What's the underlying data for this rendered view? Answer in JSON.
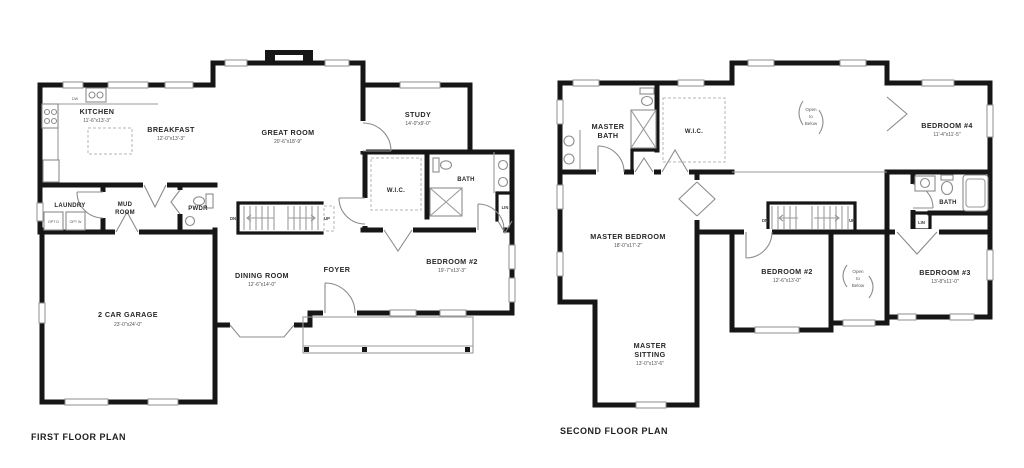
{
  "colors": {
    "wall": "#161616",
    "line": "#8c8c8c",
    "text": "#272727"
  },
  "first_floor": {
    "title": "FIRST FLOOR PLAN",
    "rooms": {
      "kitchen": {
        "name": "KITCHEN",
        "dims": "11'-6\"x13'-3\""
      },
      "breakfast": {
        "name": "BREAKFAST",
        "dims": "12'-0\"x13'-3\""
      },
      "great_room": {
        "name": "GREAT ROOM",
        "dims": "20'-6\"x18'-9\""
      },
      "study": {
        "name": "STUDY",
        "dims": "14'-0\"x9'-0\""
      },
      "laundry": {
        "name": "LAUNDRY"
      },
      "mud_room": {
        "line1": "MUD",
        "line2": "ROOM"
      },
      "pwdr": {
        "name": "PWDR"
      },
      "wic": {
        "name": "W.I.C."
      },
      "bath": {
        "name": "BATH"
      },
      "lin": {
        "name": "LIN"
      },
      "dining": {
        "name": "DINING ROOM",
        "dims": "12'-6\"x14'-0\""
      },
      "foyer": {
        "name": "FOYER"
      },
      "bedroom2": {
        "name": "BEDROOM #2",
        "dims": "19'-7\"x13'-3\""
      },
      "garage": {
        "name": "2 CAR GARAGE",
        "dims": "23'-0\"x24'-0\""
      }
    },
    "stairs": {
      "dn": "DN",
      "up": "UP"
    },
    "appliances": {
      "dw": "DW",
      "opt_d": "OPT D",
      "opt_w": "OPT W"
    }
  },
  "second_floor": {
    "title": "SECOND FLOOR PLAN",
    "rooms": {
      "master_bath": {
        "line1": "MASTER",
        "line2": "BATH"
      },
      "wic": {
        "name": "W.I.C."
      },
      "bedroom4": {
        "name": "BEDROOM #4",
        "dims": "11'-4\"x11'-5\""
      },
      "master_bedroom": {
        "name": "MASTER BEDROOM",
        "dims": "18'-0\"x17'-2\""
      },
      "bath": {
        "name": "BATH"
      },
      "lin": {
        "name": "LIN"
      },
      "bedroom2": {
        "name": "BEDROOM #2",
        "dims": "12'-6\"x13'-0\""
      },
      "bedroom3": {
        "name": "BEDROOM #3",
        "dims": "13'-8\"x11'-0\""
      },
      "master_sitting": {
        "line1": "MASTER",
        "line2": "SITTING",
        "dims": "13'-0\"x13'-6\""
      }
    },
    "open_below_top": [
      "Open",
      "to",
      "Below"
    ],
    "open_below_small": [
      "Open",
      "to",
      "Below"
    ],
    "stairs": {
      "dn": "DN",
      "up": "UP"
    }
  }
}
